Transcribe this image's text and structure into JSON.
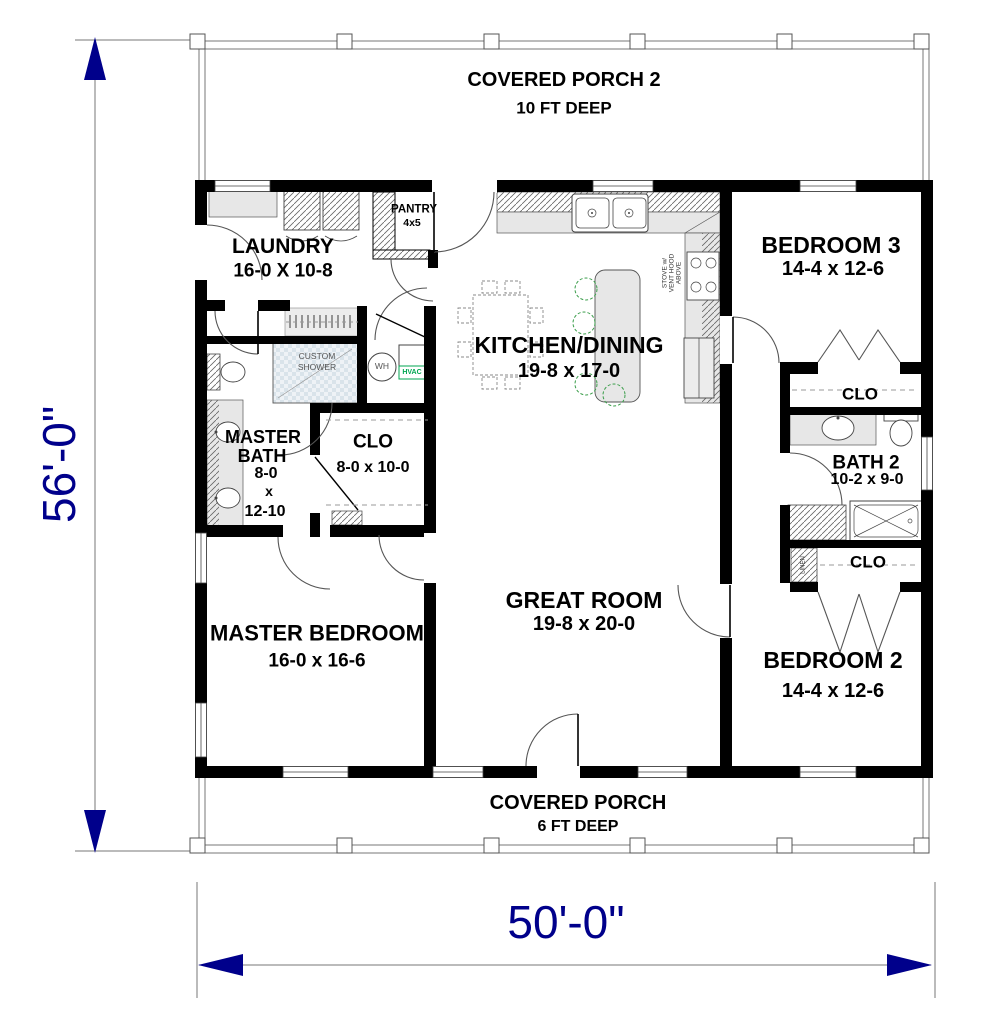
{
  "dimensions": {
    "height": "56'-0\"",
    "width": "50'-0\""
  },
  "porch_top": {
    "name": "COVERED PORCH 2",
    "depth": "10 FT DEEP"
  },
  "porch_bottom": {
    "name": "COVERED PORCH",
    "depth": "6 FT DEEP"
  },
  "rooms": {
    "laundry": {
      "name": "LAUNDRY",
      "dims": "16-0 X 10-8"
    },
    "pantry": {
      "name": "PANTRY",
      "dims": "4x5"
    },
    "kitchen": {
      "name": "KITCHEN/DINING",
      "dims": "19-8 x 17-0"
    },
    "bedroom3": {
      "name": "BEDROOM 3",
      "dims": "14-4 x 12-6"
    },
    "bedroom3_closet": {
      "name": "CLO"
    },
    "bath2": {
      "name": "BATH 2",
      "dims": "10-2 x 9-0"
    },
    "bedroom2_closet": {
      "name": "CLO"
    },
    "master_bath": {
      "line1": "MASTER",
      "line2": "BATH",
      "line3": "8-0",
      "line4": "x",
      "line5": "12-10"
    },
    "master_closet": {
      "name": "CLO",
      "dims": "8-0 x 10-0"
    },
    "great_room": {
      "name": "GREAT ROOM",
      "dims": "19-8 x 20-0"
    },
    "master_bedroom": {
      "name": "MASTER BEDROOM",
      "dims": "16-0 x 16-6"
    },
    "bedroom2": {
      "name": "BEDROOM 2",
      "dims": "14-4 x 12-6"
    }
  },
  "fixtures": {
    "shower_line1": "CUSTOM",
    "shower_line2": "SHOWER",
    "water_heater": "WH",
    "hvac": "HVAC",
    "linen": "LINEN",
    "stove_line1": "STOVE w/",
    "stove_line2": "VENT HOOD",
    "stove_line3": "ABOVE"
  },
  "colors": {
    "wall": "#000000",
    "dimension": "#00008B",
    "hvac_green": "#00a651"
  }
}
